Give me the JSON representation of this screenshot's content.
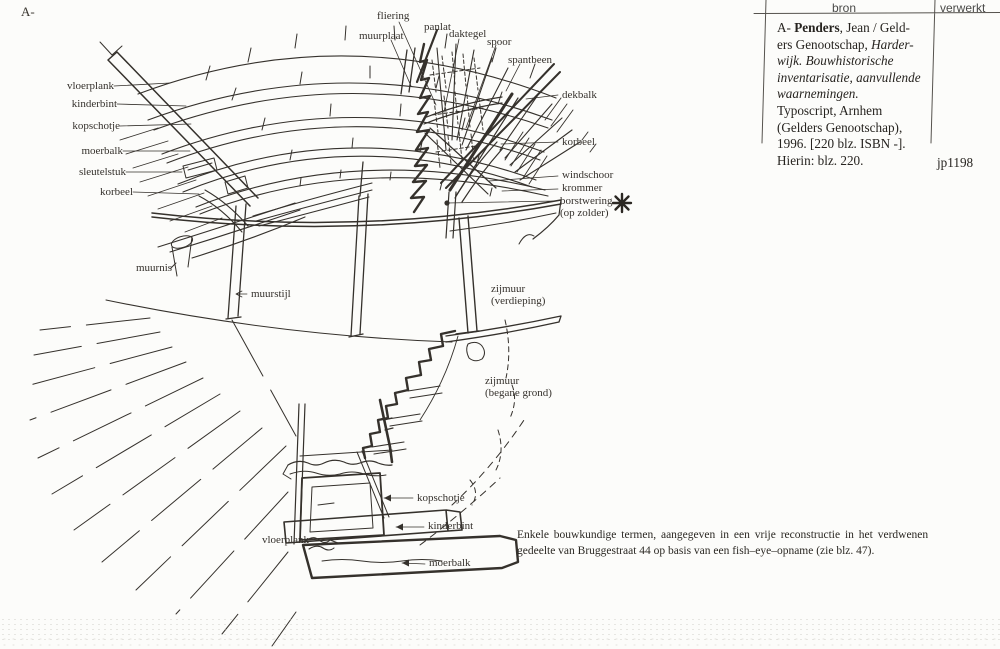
{
  "page_marker": "A-",
  "table": {
    "bron_header": "bron",
    "verwerkt_header": "verwerkt",
    "citation": {
      "l1a": "A- ",
      "l1b": "Penders",
      "l1c": ", Jean / Geld-",
      "l2a": "ers Genootschap, ",
      "l2b": "Harder-",
      "l3": "wijk. Bouwhistorische",
      "l4": "inventarisatie, aanvullende",
      "l5": "waarnemingen.",
      "l6": "Typoscript, Arnhem",
      "l7": "(Gelders Genootschap),",
      "l8": "1996. [220 blz. ISBN -].",
      "l9": "Hierin: blz. 220."
    },
    "code": "jp1198"
  },
  "caption": {
    "line1": "Enkele bouwkundige termen, aangegeven in een vrije reconstructie in het verdwenen",
    "line2": "gedeelte van Bruggestraat 44 op basis van een fish–eye–opname (zie blz. 47)."
  },
  "drawing": {
    "labels": {
      "fliering": "fliering",
      "panlat": "panlat",
      "muurplaat": "muurplaat",
      "daktegel": "daktegel",
      "spoor": "spoor",
      "spantbeen": "spantbeen",
      "vloerplank_top": "vloerplank",
      "kinderbint_top": "kinderbint",
      "kopschotje_top": "kopschotje",
      "moerbalk_top": "moerbalk",
      "sleutelstuk": "sleutelstuk",
      "korbeel_left": "korbeel",
      "dekbalk": "dekbalk",
      "korbeel_right": "korbeel",
      "windschoor": "windschoor",
      "krommer": "krommer",
      "borstwering": "borstwering",
      "borstwering_sub": "(op zolder)",
      "muurnis": "muurnis",
      "muurstijl": "muurstijl",
      "zijmuur_1": "zijmuur",
      "zijmuur_1_sub": "(verdieping)",
      "zijmuur_2": "zijmuur",
      "zijmuur_2_sub": "(begane grond)",
      "kopschotje_bottom": "kopschotje",
      "kinderbint_bottom": "kinderbint",
      "vloerplank_bottom": "vloerplank",
      "moerbalk_bottom": "moerbalk"
    },
    "colors": {
      "ink": "#35312c",
      "paper": "#fcfcfa"
    }
  }
}
